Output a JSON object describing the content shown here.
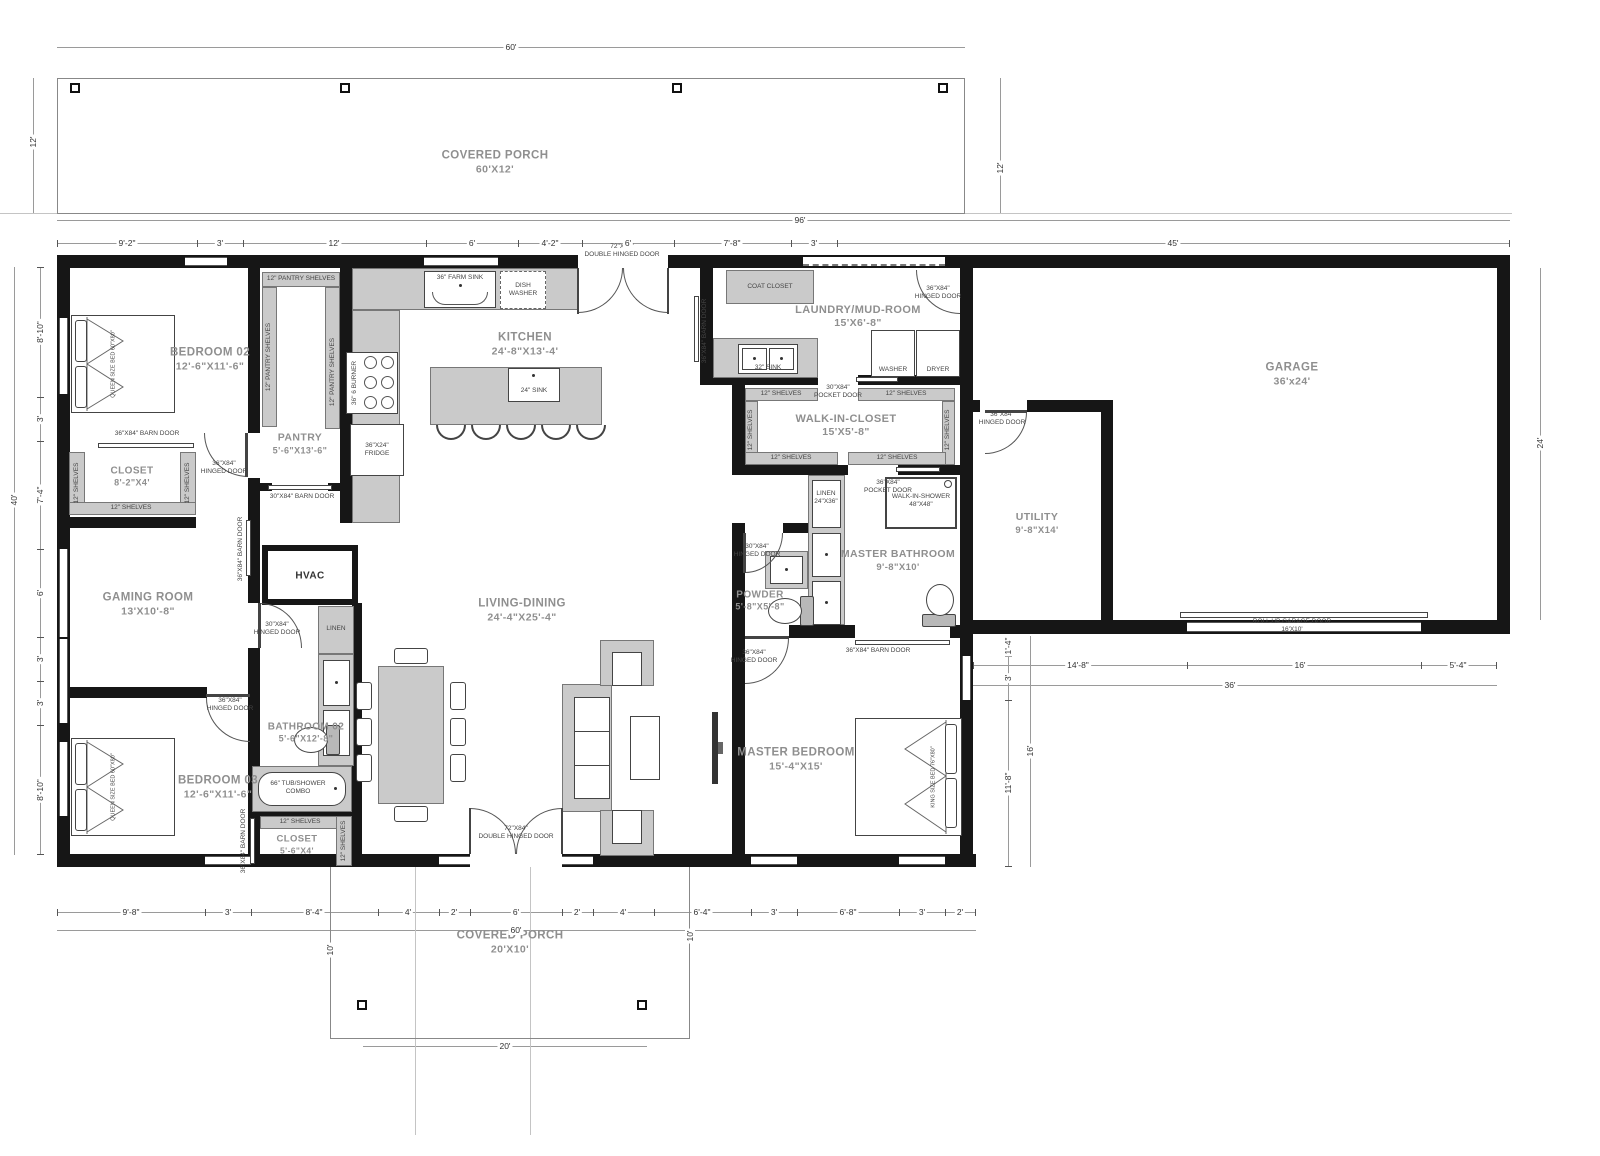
{
  "rooms": {
    "porch_top": {
      "name": "COVERED PORCH",
      "size": "60'X12'"
    },
    "porch_bottom": {
      "name": "COVERED PORCH",
      "size": "20'X10'"
    },
    "bedroom02": {
      "name": "BEDROOM 02",
      "size": "12'-6\"X11'-6\""
    },
    "closet02": {
      "name": "CLOSET",
      "size": "8'-2\"X4'"
    },
    "pantry": {
      "name": "PANTRY",
      "size": "5'-6\"X13'-6\""
    },
    "kitchen": {
      "name": "KITCHEN",
      "size": "24'-8\"X13'-4'"
    },
    "laundry": {
      "name": "LAUNDRY/MUD-ROOM",
      "size": "15'X6'-8\""
    },
    "wic": {
      "name": "WALK-IN-CLOSET",
      "size": "15'X5'-8\""
    },
    "garage": {
      "name": "GARAGE",
      "size": "36'x24'"
    },
    "utility": {
      "name": "UTILITY",
      "size": "9'-8\"X14'"
    },
    "master_bath": {
      "name": "MASTER BATHROOM",
      "size": "9'-8\"X10'"
    },
    "powder": {
      "name": "POWDER",
      "size": "5'-8\"X5'-8\""
    },
    "gaming": {
      "name": "GAMING ROOM",
      "size": "13'X10'-8\""
    },
    "hvac": {
      "name": "HVAC"
    },
    "bathroom02": {
      "name": "BATHROOM 02",
      "size": "5'-6\"X12'-8\""
    },
    "bedroom03": {
      "name": "BEDROOM 03",
      "size": "12'-6\"X11'-6\""
    },
    "living": {
      "name": "LIVING-DINING",
      "size": "24'-4\"X25'-4\""
    },
    "master_bedroom": {
      "name": "MASTER BEDROOM",
      "size": "15'-4\"X15'"
    },
    "closet03": {
      "name": "CLOSET",
      "size": "5'-6\"X4'"
    }
  },
  "fixtures": {
    "farm_sink": "36\" FARM SINK",
    "dishwasher": "DISH WASHER",
    "burner": "36\" 6 BURNER",
    "fridge": "36\"X24\" FRIDGE",
    "island_sink": "24\" SINK",
    "coat_closet": "COAT CLOSET",
    "laundry_sink": "32\" SINK",
    "washer": "WASHER",
    "dryer": "DRYER",
    "shelves": "12\" SHELVES",
    "pantry_shelves": "12\" PANTRY SHELVES",
    "linen": "LINEN",
    "linen_size": "24\"X36\"",
    "shower": "WALK-IN-SHOWER",
    "shower_size": "48\"X48\"",
    "tub": "66\" TUB/SHOWER COMBO",
    "queen_bed": "QUEEN SIZE BED 60\"X80\"",
    "king_bed": "KING SIZE BED 76\"X80\"",
    "rollup": "ROLL UP GARAGE DOOR",
    "rollup_size": "16'X10'"
  },
  "doors": {
    "d72": {
      "size": "72\"X84\"",
      "type": "DOUBLE HINGED DOOR"
    },
    "h36": {
      "size": "36\"X84\"",
      "type": "HINGED DOOR"
    },
    "h30": {
      "size": "30\"X84\"",
      "type": "HINGED DOOR"
    },
    "p30": {
      "size": "30\"X84\"",
      "type": "POCKET DOOR"
    },
    "p36": {
      "size": "36\"X84\"",
      "type": "POCKET DOOR"
    },
    "b36": {
      "size": "36\"X84\"",
      "type": "BARN DOOR",
      "full": "36\"X84\" BARN DOOR"
    },
    "b30": {
      "size": "30\"X84\"",
      "type": "BARN DOOR",
      "full": "30\"X84\" BARN DOOR"
    }
  },
  "dims": {
    "top_porch_width": "60'",
    "porch_depth_left": "12'",
    "porch_depth_right": "12'",
    "top_overall": "96'",
    "top": [
      "9'-2\"",
      "3'",
      "12'",
      "6'",
      "4'-2\"",
      "6'",
      "7'-8\"",
      "3'",
      "45'"
    ],
    "left": [
      "8'-10\"",
      "3'",
      "7'-4\"",
      "6'",
      "3'",
      "3'",
      "8'-10\""
    ],
    "left_overall": "40'",
    "garage_right": "24'",
    "garage_bottom": [
      "14'-8\"",
      "16'",
      "5'-4\""
    ],
    "garage_bottom_overall": "36'",
    "master_right": [
      "1'-4\"",
      "3'",
      "11'-8\""
    ],
    "master_right_overall": "16'",
    "bottom": [
      "9'-8\"",
      "3'",
      "8'-4\"",
      "4'",
      "2'",
      "6'",
      "2'",
      "4'",
      "6'-4\"",
      "3'",
      "6'-8\"",
      "3'",
      "2'"
    ],
    "bottom_overall": "60'",
    "porch_bottom_width": "20'",
    "porch_bottom_depth_left": "10'",
    "porch_bottom_depth_right": "10'"
  }
}
